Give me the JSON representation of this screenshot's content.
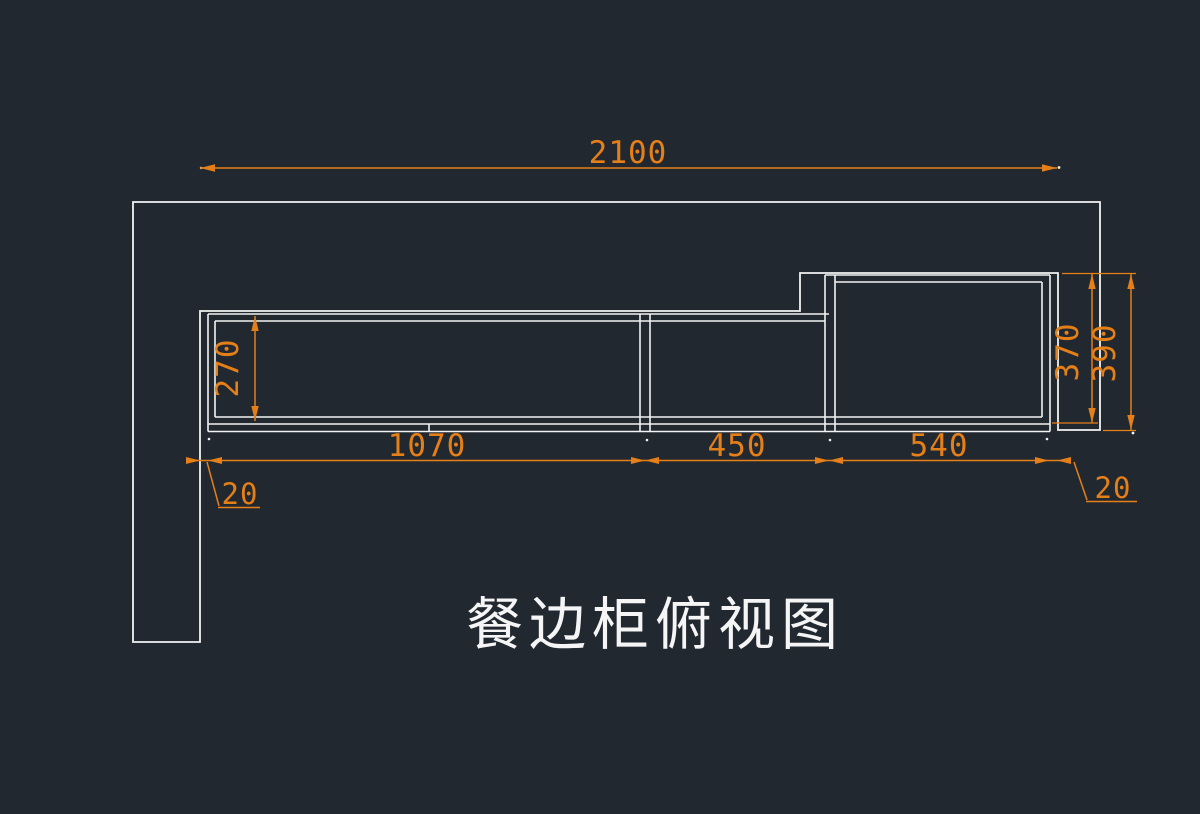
{
  "drawing": {
    "title": "餐边柜俯视图",
    "dimensions": {
      "total_width": "2100",
      "left_section_depth": "270",
      "right_section_depth": "370",
      "right_section_depth_with_door": "390",
      "section_widths": [
        "1070",
        "450",
        "540"
      ],
      "left_gap": "20",
      "right_gap": "20"
    },
    "hatch": "herringbone-parquet-45deg",
    "colors": {
      "background": "#212830",
      "lines": "#f2f2f2",
      "dimension": "#e57f17"
    }
  }
}
